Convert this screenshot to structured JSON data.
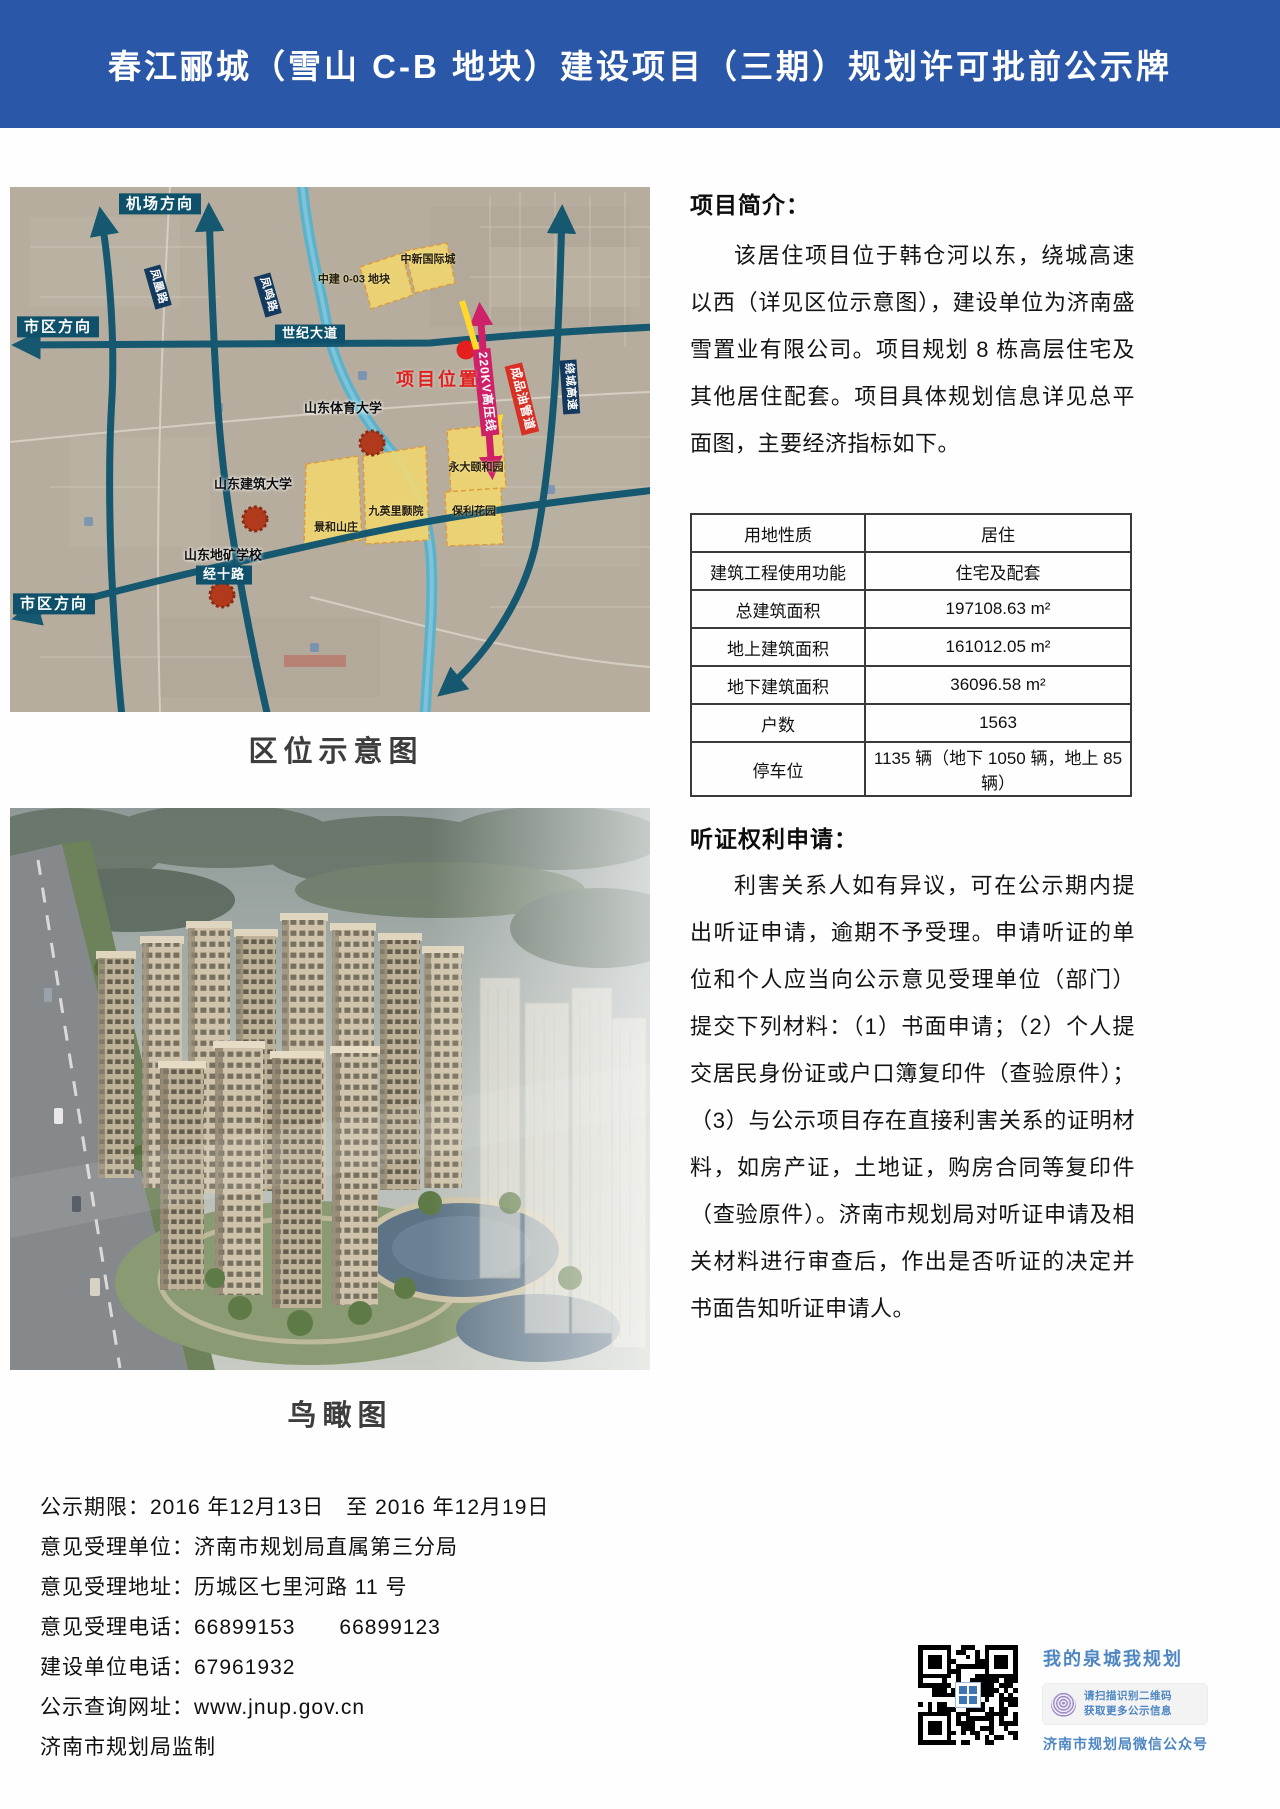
{
  "header": {
    "title": "春江郦城（雪山 C-B 地块）建设项目（三期）规划许可批前公示牌"
  },
  "map": {
    "caption": "区位示意图",
    "labels": {
      "airport_direction": "机场方向",
      "city_direction": "市区方向",
      "city_direction2": "市区方向",
      "road_left": "凤凰路",
      "road_right": "凤鸣路",
      "century_avenue": "世纪大道",
      "jingshi_road": "经十路",
      "raocheng_expressway": "绕城高速",
      "power_line": "220KV高压线",
      "oil_pipeline": "成品油管道",
      "project_location": "项目位置",
      "parcel_zhongxin": "中新国际城",
      "parcel_zhongjian": "中建 0-03 地块",
      "parcel_yongda": "永大颐和园",
      "parcel_jiuyingli": "九英里颢院",
      "parcel_baoli": "保利花园",
      "parcel_jinghe": "景和山庄",
      "univ_sport": "山东体育大学",
      "univ_jianzhu": "山东建筑大学",
      "school_dikuang": "山东地矿学校"
    }
  },
  "aerial": {
    "caption": "鸟瞰图"
  },
  "intro": {
    "heading": "项目简介：",
    "paragraph": "该居住项目位于韩仓河以东，绕城高速以西（详见区位示意图），建设单位为济南盛雪置业有限公司。项目规划 8 栋高层住宅及其他居住配套。项目具体规划信息详见总平面图，主要经济指标如下。"
  },
  "table": {
    "rows": [
      {
        "label": "用地性质",
        "value": "居住"
      },
      {
        "label": "建筑工程使用功能",
        "value": "住宅及配套"
      },
      {
        "label": "总建筑面积",
        "value": "197108.63 m²"
      },
      {
        "label": "地上建筑面积",
        "value": "161012.05 m²"
      },
      {
        "label": "地下建筑面积",
        "value": "36096.58 m²"
      },
      {
        "label": "户数",
        "value": "1563"
      },
      {
        "label": "停车位",
        "value": "1135 辆（地下 1050 辆，地上 85 辆）"
      }
    ]
  },
  "hearing": {
    "heading": "听证权利申请：",
    "paragraph": "利害关系人如有异议，可在公示期内提出听证申请，逾期不予受理。申请听证的单位和个人应当向公示意见受理单位（部门）提交下列材料：（1）书面申请；（2）个人提交居民身份证或户口簿复印件（查验原件）；（3）与公示项目存在直接利害关系的证明材料，如房产证，土地证，购房合同等复印件（查验原件）。济南市规划局对听证申请及相关材料进行审查后，作出是否听证的决定并书面告知听证申请人。"
  },
  "footer": {
    "lines": [
      "公示期限：2016 年12月13日　至 2016 年12月19日",
      "意见受理单位：济南市规划局直属第三分局",
      "意见受理地址：历城区七里河路 11 号",
      "意见受理电话：66899153　　66899123",
      "建设单位电话：67961932",
      "公示查询网址：www.jnup.gov.cn",
      "济南市规划局监制"
    ]
  },
  "qr": {
    "slogan": "我的泉城我规划",
    "badge_line1": "请扫描识别二维码",
    "badge_line2": "获取更多公示信息",
    "account": "济南市规划局微信公众号"
  },
  "colors": {
    "header_bg": "#2b57a8",
    "header_text": "#ffffff",
    "qr_text_blue": "#4d86c3",
    "map_road_teal": "#15586f",
    "map_river": "#5ab1cd",
    "parcel_yellow": "#eed672",
    "project_red": "#e3201d",
    "powerline_magenta": "#cf2168",
    "pipeline_label_red": "#d93025"
  }
}
